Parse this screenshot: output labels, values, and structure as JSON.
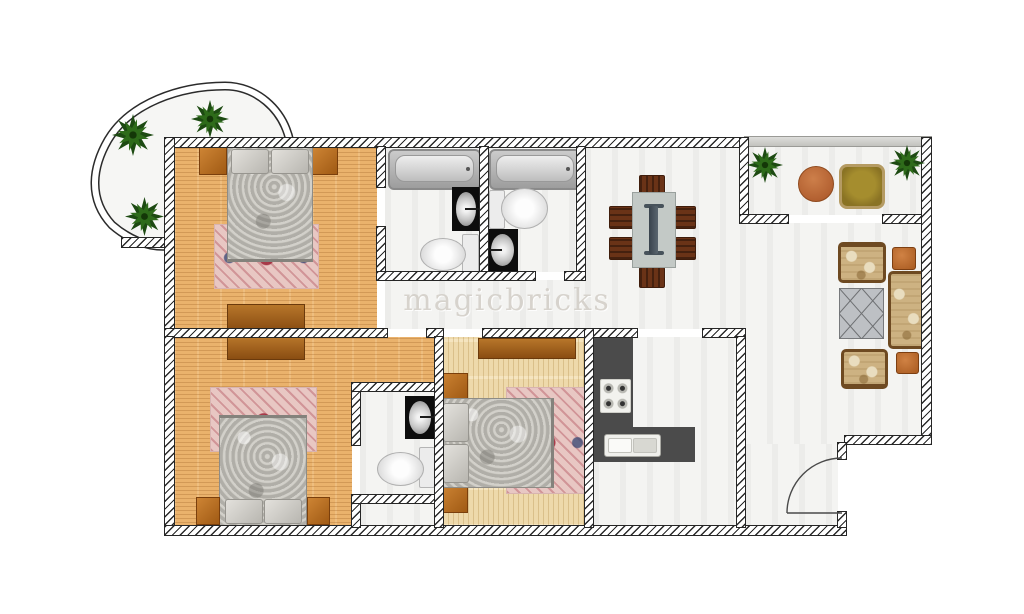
{
  "watermark": {
    "text": "magicbricks"
  },
  "plan": {
    "type": "apartment-floor-plan",
    "rooms": [
      {
        "name": "round-balcony",
        "furniture": [
          "plant",
          "plant",
          "plant"
        ]
      },
      {
        "name": "bedroom-1",
        "furniture": [
          "double-bed",
          "rug",
          "nightstand-left",
          "nightstand-right",
          "dresser"
        ]
      },
      {
        "name": "ensuite-bathroom-1",
        "furniture": [
          "bathtub",
          "washbasin",
          "toilet"
        ]
      },
      {
        "name": "bathroom-2",
        "furniture": [
          "bathtub",
          "toilet",
          "washbasin"
        ]
      },
      {
        "name": "hallway",
        "furniture": []
      },
      {
        "name": "bedroom-2",
        "furniture": [
          "double-bed",
          "rug",
          "nightstand-left",
          "nightstand-right",
          "dresser"
        ]
      },
      {
        "name": "bathroom-3",
        "furniture": [
          "washbasin",
          "toilet"
        ]
      },
      {
        "name": "bedroom-3",
        "furniture": [
          "double-bed",
          "rug",
          "nightstand-top",
          "nightstand-bottom",
          "dresser"
        ]
      },
      {
        "name": "kitchen",
        "furniture": [
          "l-shaped-counter",
          "gas-hob",
          "double-sink"
        ]
      },
      {
        "name": "living-dining",
        "furniture": [
          "dining-table",
          "six-chairs",
          "armchair",
          "armchair",
          "sofa",
          "coffee-table",
          "side-table",
          "side-table"
        ]
      },
      {
        "name": "terrace",
        "furniture": [
          "plant",
          "plant",
          "round-table",
          "armchair"
        ]
      },
      {
        "name": "entry-hall",
        "furniture": [
          "entry-door-swing"
        ]
      }
    ],
    "colors": {
      "wood_dark": "#eab26c",
      "wood_light": "#eed9ab",
      "wall_hatch": "#2a2a2a",
      "kitchen_counter": "#4b4b4b",
      "rug_base": "#e8c7c3",
      "rug_accent": "#9c2234",
      "rug_accent2": "#3e4c76",
      "upholstery": "#cdb282",
      "upholstery_trim": "#6e4a22",
      "plant_green": "#2e6b1a",
      "table_top": "#c3c9c6",
      "runner": "#47525b"
    }
  }
}
